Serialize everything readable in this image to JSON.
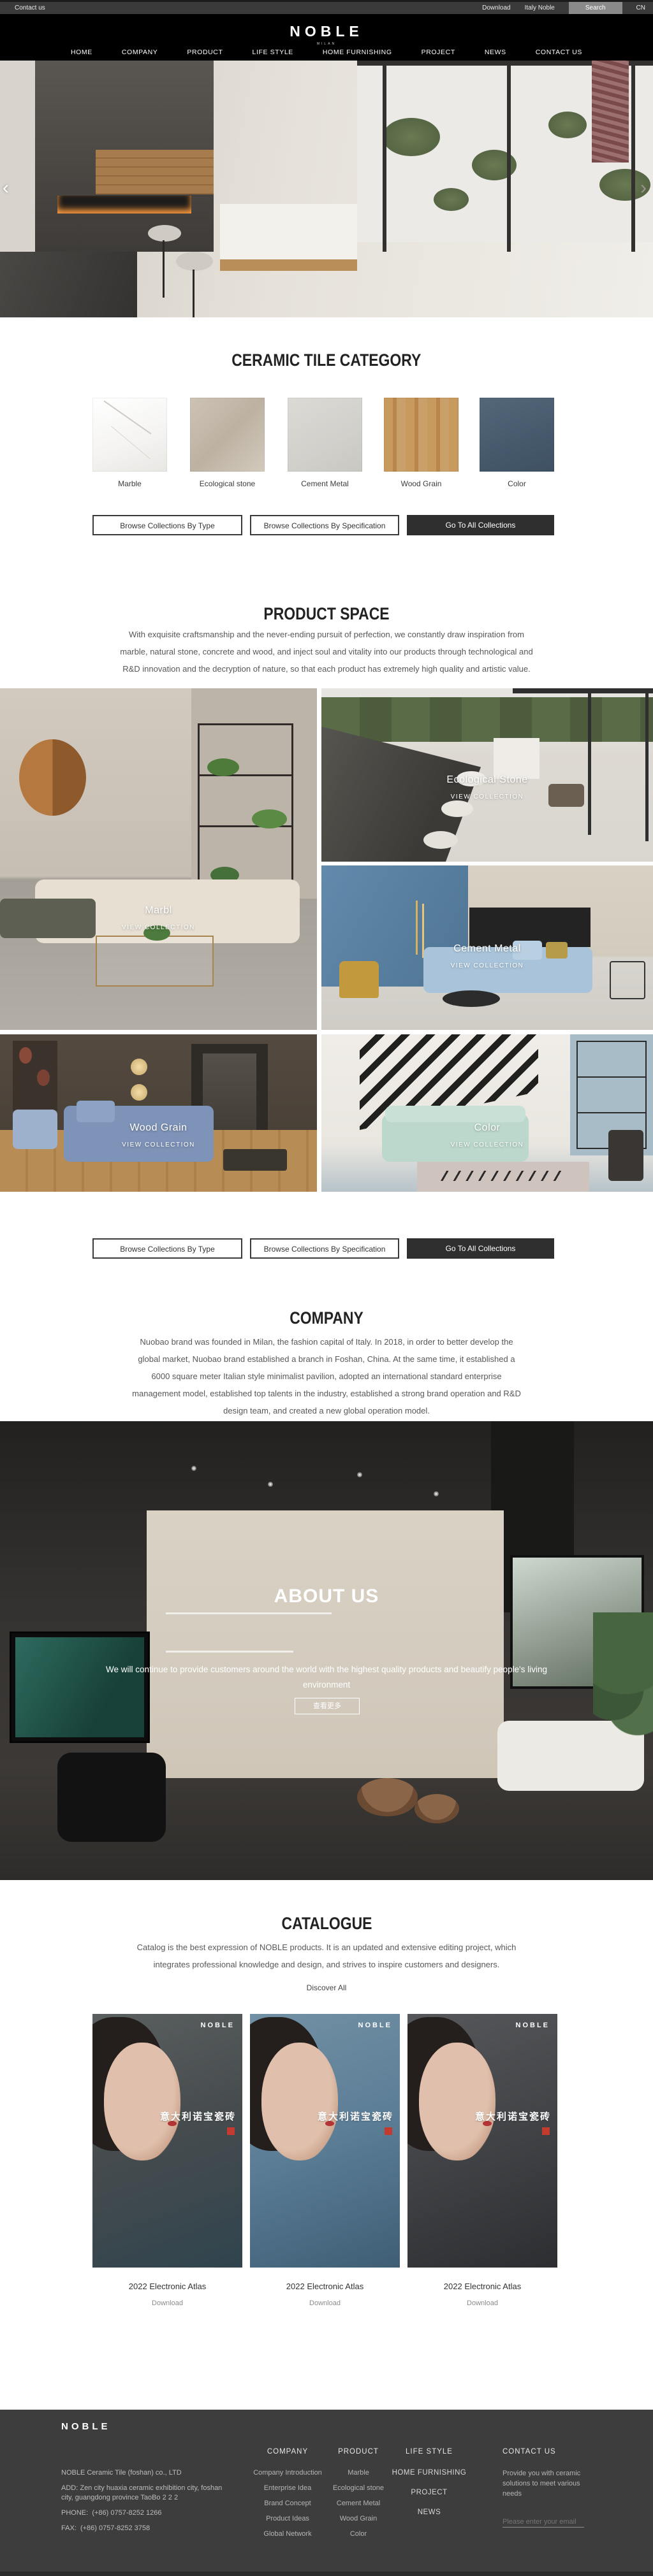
{
  "topbar": {
    "contact": "Contact us",
    "download": "Download",
    "italy": "Italy Noble",
    "search": "Search",
    "lang": "CN"
  },
  "header": {
    "logo": "NOBLE",
    "logo_sub": "MILAN",
    "nav": [
      {
        "label": "HOME"
      },
      {
        "label": "COMPANY"
      },
      {
        "label": "PRODUCT"
      },
      {
        "label": "LIFE STYLE"
      },
      {
        "label": "HOME FURNISHING"
      },
      {
        "label": "PROJECT"
      },
      {
        "label": "NEWS"
      },
      {
        "label": "CONTACT US"
      }
    ]
  },
  "hero": {
    "prev": "‹",
    "next": "›"
  },
  "category": {
    "title": "CERAMIC TILE CATEGORY",
    "items": [
      {
        "label": "Marble"
      },
      {
        "label": "Ecological stone"
      },
      {
        "label": "Cement Metal"
      },
      {
        "label": "Wood Grain"
      },
      {
        "label": "Color"
      }
    ],
    "buttons": [
      {
        "label": "Browse Collections By Type"
      },
      {
        "label": "Browse Collections By Specification"
      },
      {
        "label": "Go To All Collections"
      }
    ]
  },
  "product_space": {
    "title": "PRODUCT SPACE",
    "paragraph": "With exquisite craftsmanship and the never-ending pursuit of perfection, we constantly draw inspiration from marble, natural stone, concrete and wood, and inject soul and vitality into our products through technological and R&D innovation and the decryption of nature, so that each product has extremely high quality and artistic value.",
    "tiles": [
      {
        "name": "Marbl",
        "cta": "VIEW COLLECTION"
      },
      {
        "name": "Ecological Stone",
        "cta": "VIEW COLLECTION"
      },
      {
        "name": "Cement Metal",
        "cta": "VIEW COLLECTION"
      },
      {
        "name": "Wood Grain",
        "cta": "VIEW COLLECTION"
      },
      {
        "name": "Color",
        "cta": "VIEW COLLECTION"
      }
    ]
  },
  "company": {
    "title": "COMPANY",
    "paragraph": "Nuobao brand was founded in Milan, the fashion capital of Italy. In 2018, in order to better develop the global market, Nuobao brand established a branch in Foshan, China. At the same time, it established a 6000 square meter Italian style minimalist pavilion, adopted an international standard enterprise management model, established top talents in the industry, established a strong brand operation and R&D design team, and created a new global operation model."
  },
  "about": {
    "title": "ABOUT US",
    "paragraph": "We will continue to provide customers around the world with the highest quality products and beautify people's living environment",
    "more": "查看更多"
  },
  "catalogue": {
    "title": "CATALOGUE",
    "paragraph": "Catalog is the best expression of NOBLE products. It is an updated and extensive editing project, which integrates professional knowledge and design, and strives to inspire customers and designers.",
    "discover": "Discover All",
    "poster_brand": "NOBLE",
    "poster_title": "意大利诺宝瓷砖",
    "items": [
      {
        "title": "2022 Electronic Atlas",
        "download": "Download"
      },
      {
        "title": "2022 Electronic Atlas",
        "download": "Download"
      },
      {
        "title": "2022 Electronic Atlas",
        "download": "Download"
      }
    ]
  },
  "footer": {
    "logo": "NOBLE",
    "company_name": "NOBLE Ceramic Tile (foshan) co., LTD",
    "address_label": "ADD:",
    "address": "Zen city huaxia ceramic exhibition city, foshan city, guangdong province TaoBo 2 2 2",
    "phone_label": "PHONE:",
    "phone": "(+86) 0757-8252 1266",
    "fax_label": "FAX:",
    "fax": "(+86) 0757-8252 3758",
    "columns": [
      {
        "title": "COMPANY",
        "links": [
          "Company Introduction",
          "Enterprise Idea",
          "Brand Concept",
          "Product Ideas",
          "Global Network"
        ]
      },
      {
        "title": "PRODUCT",
        "links": [
          "Marble",
          "Ecological stone",
          "Cement Metal",
          "Wood Grain",
          "Color"
        ]
      },
      {
        "title": "LIFE STYLE",
        "links": [
          "HOME FURNISHING",
          "PROJECT",
          "NEWS"
        ]
      }
    ],
    "contact": {
      "title": "CONTACT US",
      "blurb": "Provide you with ceramic solutions to meet various needs",
      "email_placeholder": "Please enter your email"
    }
  }
}
